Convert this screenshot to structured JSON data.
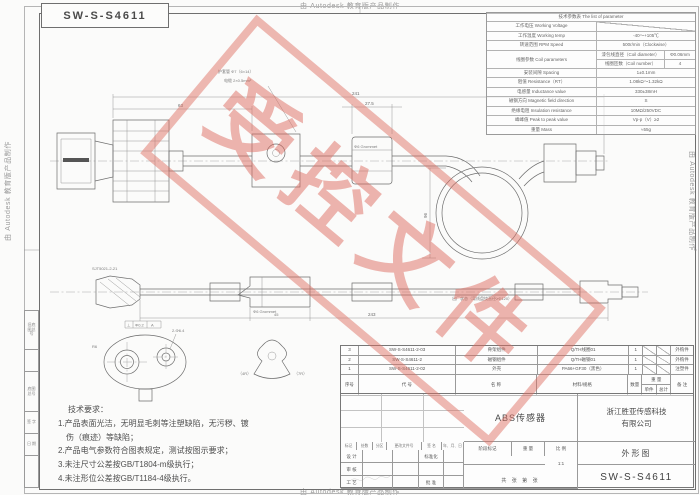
{
  "frame": {
    "autodesk_note": "由 Autodesk 教育版产品制作",
    "titlebox_text": "SW-S-S4611"
  },
  "margin_labels": [
    "旧底图总号",
    "",
    "底图总号",
    "签 字",
    "日 期",
    ""
  ],
  "spec_table": {
    "title": "技术参数表 The list of parameter",
    "rows": [
      {
        "label": "工作电压 Working Voltage",
        "value": ""
      },
      {
        "label": "工作温度 Working temp",
        "value": "-40～+105℃"
      },
      {
        "label": "转速范围 RPM Speed",
        "value": "500r/min（Clockwise）"
      },
      {
        "label": "线圈参数 Coil parameters",
        "sub": [
          {
            "name": "漆包线直径（Coil diameter）",
            "value": "Φ0.06mm"
          },
          {
            "name": "线圈匝数（Coil number）",
            "value": "4"
          }
        ]
      },
      {
        "label": "安装间隙 Spacing",
        "value": "1±0.1mm"
      },
      {
        "label": "阻值 Resistance（RT）",
        "value": "1.08kΩ～1.32kΩ"
      },
      {
        "label": "电感量 Inductance value",
        "value": "330±38mH"
      },
      {
        "label": "磁钢方向 Magnetic field direction",
        "value": "S"
      },
      {
        "label": "绝缘电阻 Insulation resistance",
        "value": "10MΩ/250VDC"
      },
      {
        "label": "峰峰值 Peak to peak value",
        "value": "Vp-p（V）≥2"
      },
      {
        "label": "重量 Mass",
        "value": "≈55g"
      }
    ]
  },
  "bom": {
    "headers": {
      "no": "序号",
      "code": "代 号",
      "name": "名 称",
      "material": "材料/规格",
      "qty": "数量",
      "weight": "重 量",
      "unit": "单件",
      "total": "总计",
      "remark": "备 注"
    },
    "rows": [
      {
        "no": "3",
        "code": "SW-S-S4611-2-03",
        "name": "骨架组件",
        "material": "Q/TH线圈01",
        "qty": "1",
        "remark": "外购件"
      },
      {
        "no": "2",
        "code": "SW-S-S4611-2",
        "name": "磁钢组件",
        "material": "Q/TH磁钢01",
        "qty": "1",
        "remark": "外购件"
      },
      {
        "no": "1",
        "code": "SW-S-S4611-2-02",
        "name": "外壳",
        "material": "PA66+GF30（黑色）",
        "qty": "1",
        "remark": "注塑件"
      }
    ]
  },
  "titleblock": {
    "product_name": "ABS传感器",
    "company_line1": "浙江胜亚传感科技",
    "company_line2": "有限公司",
    "doc_type": "外形图",
    "drawing_no": "SW-S-S4611",
    "rev_headers": [
      "标记",
      "处数",
      "分区",
      "更改文件号",
      "签 名",
      "年、月、日"
    ],
    "sig_rows": [
      {
        "l": "设 计",
        "r": "标准化"
      },
      {
        "l": "审 核",
        "r": ""
      },
      {
        "l": "工 艺",
        "r": "批 准"
      }
    ],
    "stage_label": "阶段标记",
    "weight_label": "重 量",
    "scale_label": "比 例",
    "scale_value": "1:1",
    "sheet_note": "共 张 第 张"
  },
  "tech_requirements": {
    "title": "技术要求：",
    "lines": [
      "1.产品表面光洁，无明显毛刺等注塑缺陷，无污秽、镀",
      "　伤（痕迹）等缺陷；",
      "2.产品电气参数符合图表规定，测试按图示要求；",
      "3.未注尺寸公差按GB/T1804-m级执行；",
      "4.未注形位公差按GB/T1184-4级执行。"
    ]
  },
  "watermark": {
    "text": "受控文件",
    "color": "#de6c60"
  },
  "drawing": {
    "labels": {
      "note1": "护套管 Φ7（6×14）",
      "note2": "电缆 2×0.5mm²",
      "dim_overall_top": "241",
      "dim_sub_top": "63",
      "dim_grommet_top": "27.5",
      "grommet_label_top": "Φ6 Grommet",
      "loop_dim": "96",
      "connector_model": "SJT5021-2-21",
      "grommet_label_mid": "Φ6 Grommet",
      "dim_overall_mid": "243",
      "dim_sub_mid": "45",
      "factory_note": "出厂状态（弯线盘绕直径≥Φ120）",
      "gdt_perp": "⊥",
      "gdt_tol": "Φ0.2",
      "gdt_datum": "A",
      "hole_label": "2-Φ6.4",
      "radius_label": "R6",
      "clip_dim_left": "（4R）",
      "clip_dim_right": "（7R）"
    }
  }
}
